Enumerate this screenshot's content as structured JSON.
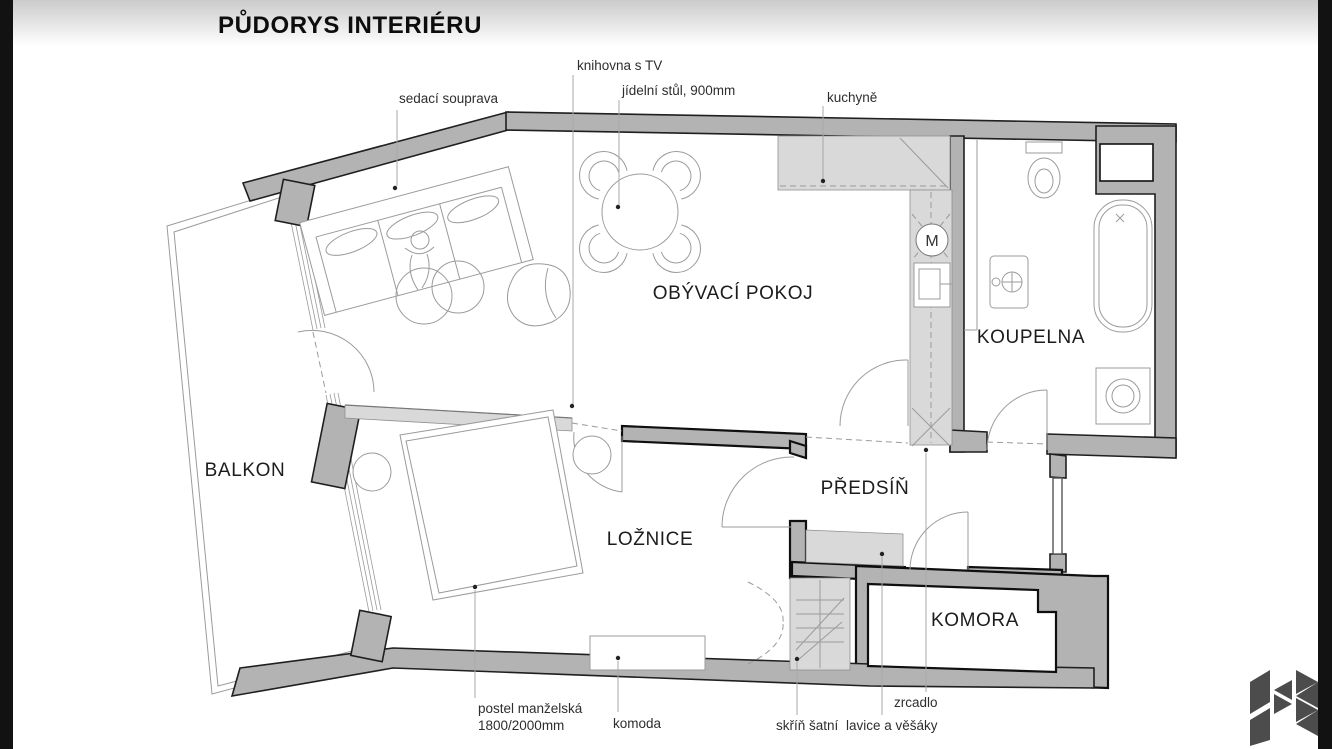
{
  "title": "PŮDORYS INTERIÉRU",
  "rooms": {
    "living": "OBÝVACÍ POKOJ",
    "bathroom": "KOUPELNA",
    "balcony": "BALKON",
    "bedroom": "LOŽNICE",
    "hallway": "PŘEDSÍŇ",
    "storage": "KOMORA"
  },
  "callouts": {
    "sofa": "sedací souprava",
    "bookcase": "knihovna s TV",
    "dining_table": "jídelní stůl, 900mm",
    "kitchen": "kuchyně",
    "bed_line1": "postel manželská",
    "bed_line2": "1800/2000mm",
    "dresser": "komoda",
    "wardrobe": "skříň šatní",
    "bench": "lavice a věšáky",
    "mirror": "zrcadlo"
  },
  "symbols": {
    "washer": "M"
  },
  "colors": {
    "wall": "#b3b3b3",
    "furniture_shade": "#d9d9d9",
    "outline": "#1f1f1f",
    "thin_line": "#9b9b9b",
    "frame_bar": "#121212",
    "logo": "#4c4c4c"
  }
}
